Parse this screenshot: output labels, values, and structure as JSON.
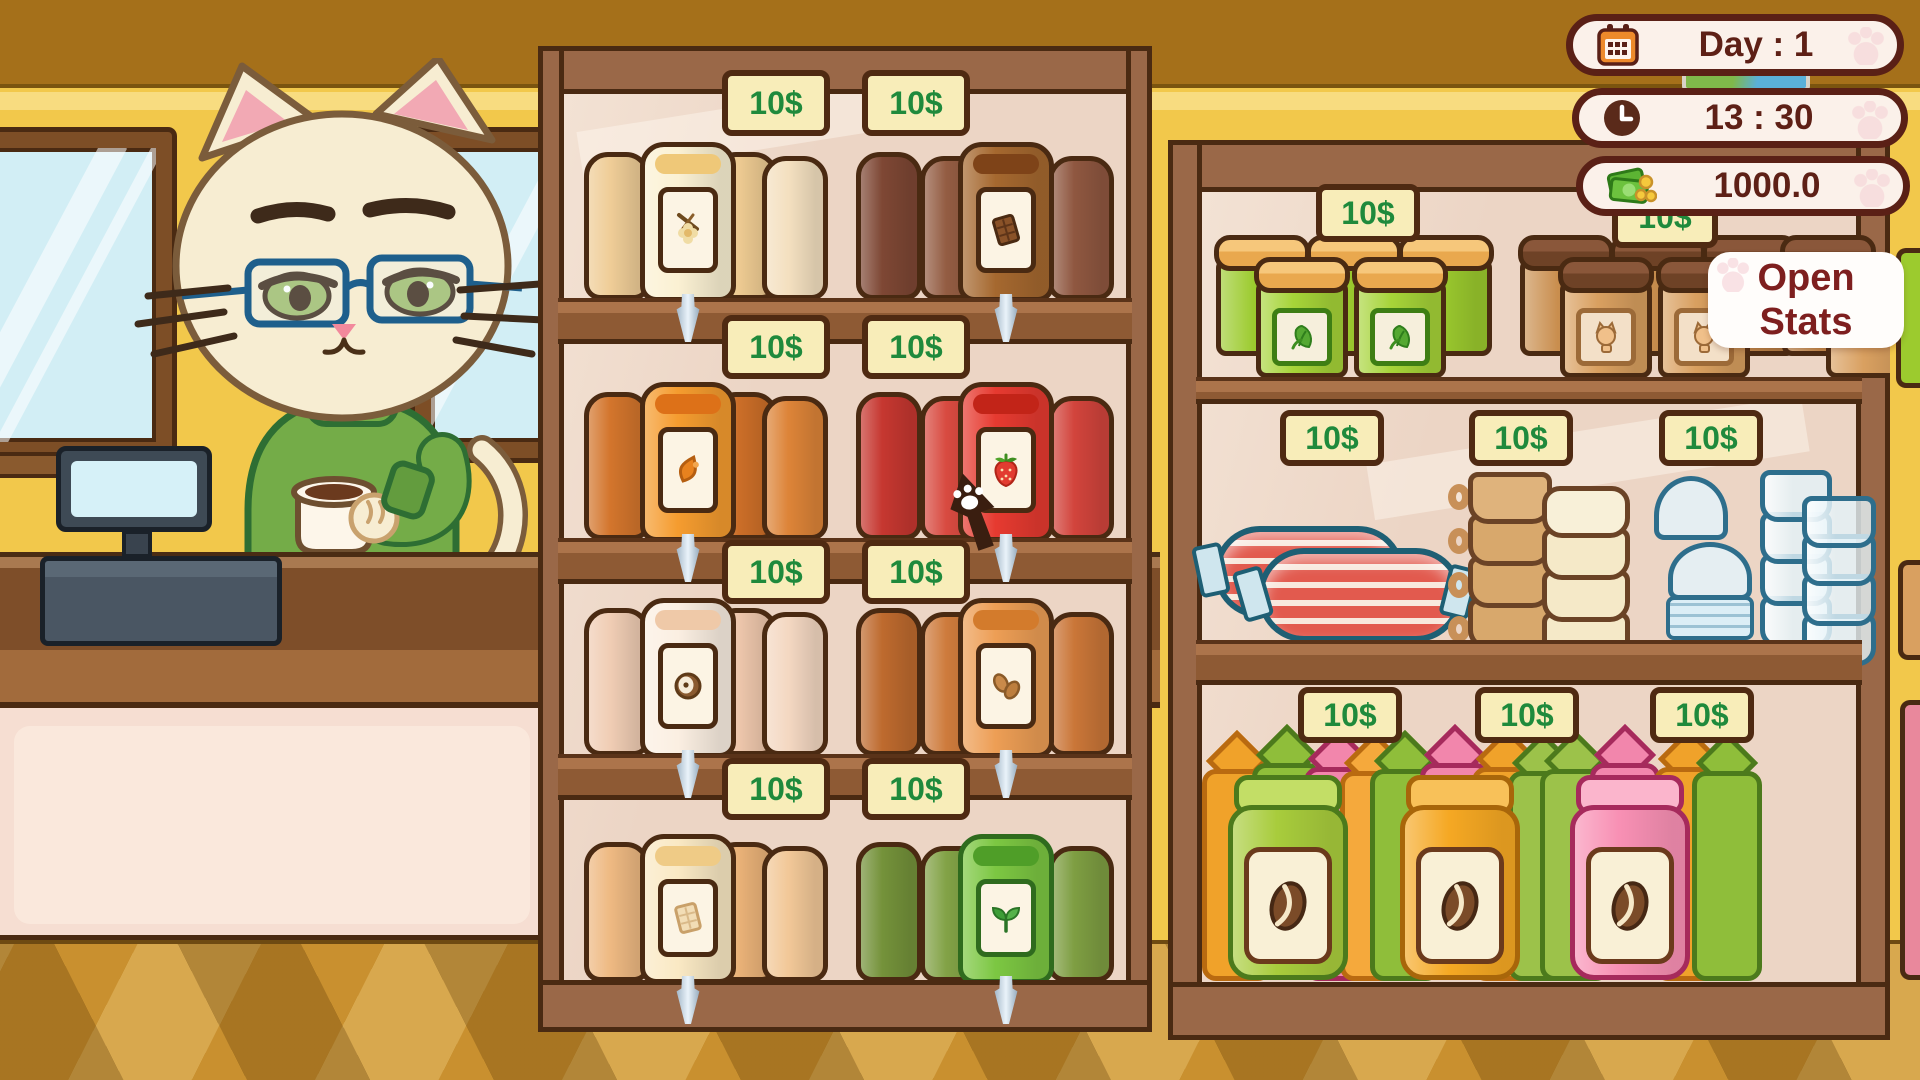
{
  "hud": {
    "day": {
      "icon": "calendar-icon",
      "label": "Day : 1"
    },
    "time": {
      "icon": "clock-icon",
      "label": "13 : 30"
    },
    "money": {
      "icon": "money-icon",
      "label": "1000.0"
    },
    "open_stats": {
      "line1": "Open",
      "line2": "Stats"
    }
  },
  "cursor": {
    "icon": "paw-print-cursor"
  },
  "colors": {
    "price_text": "#1F8A3C",
    "tag_bg": "#F8EDB9",
    "hud_text": "#5E2016",
    "open_stats_text": "#7E1F1F",
    "wall": "#F2C84B",
    "shelf_wood": "#9A6848"
  },
  "shelves": {
    "left": {
      "rows": [
        {
          "groups": [
            {
              "product": "vanilla-syrup-dispenser",
              "icon": "vanilla-flower-icon",
              "price": "10$"
            },
            {
              "product": "chocolate-syrup-dispenser",
              "icon": "chocolate-bar-icon",
              "price": "10$"
            }
          ]
        },
        {
          "groups": [
            {
              "product": "caramel-syrup-dispenser",
              "icon": "caramel-drop-icon",
              "price": "10$"
            },
            {
              "product": "strawberry-syrup-dispenser",
              "icon": "strawberry-icon",
              "price": "10$"
            }
          ]
        },
        {
          "groups": [
            {
              "product": "coconut-syrup-dispenser",
              "icon": "coconut-icon",
              "price": "10$"
            },
            {
              "product": "almond-syrup-dispenser",
              "icon": "almonds-icon",
              "price": "10$"
            }
          ]
        },
        {
          "groups": [
            {
              "product": "white-chocolate-syrup-dispenser",
              "icon": "white-chocolate-bar-icon",
              "price": "10$"
            },
            {
              "product": "matcha-syrup-dispenser",
              "icon": "sprout-icon",
              "price": "10$"
            }
          ]
        }
      ]
    },
    "right": {
      "rows": [
        {
          "groups": [
            {
              "product": "green-leaf-jars",
              "icon": "leaf-icon",
              "price": "10$"
            },
            {
              "product": "cat-food-jars",
              "icon": "cat-face-icon",
              "price": "10$"
            }
          ]
        },
        {
          "groups": [
            {
              "product": "sausage-packs",
              "icon": "sausage-icon",
              "price": "10$"
            },
            {
              "product": "stacked-mugs",
              "icon": "mug-stack-icon",
              "price": "10$"
            },
            {
              "product": "plastic-cups-lids",
              "icon": "plastic-cup-icon",
              "price": "10$"
            }
          ]
        },
        {
          "groups": [
            {
              "product": "coffee-bag-green",
              "icon": "coffee-bean-icon",
              "price": "10$"
            },
            {
              "product": "coffee-bag-orange",
              "icon": "coffee-bean-icon",
              "price": "10$"
            },
            {
              "product": "coffee-bag-pink",
              "icon": "coffee-bean-icon",
              "price": "10$"
            }
          ]
        }
      ]
    }
  }
}
